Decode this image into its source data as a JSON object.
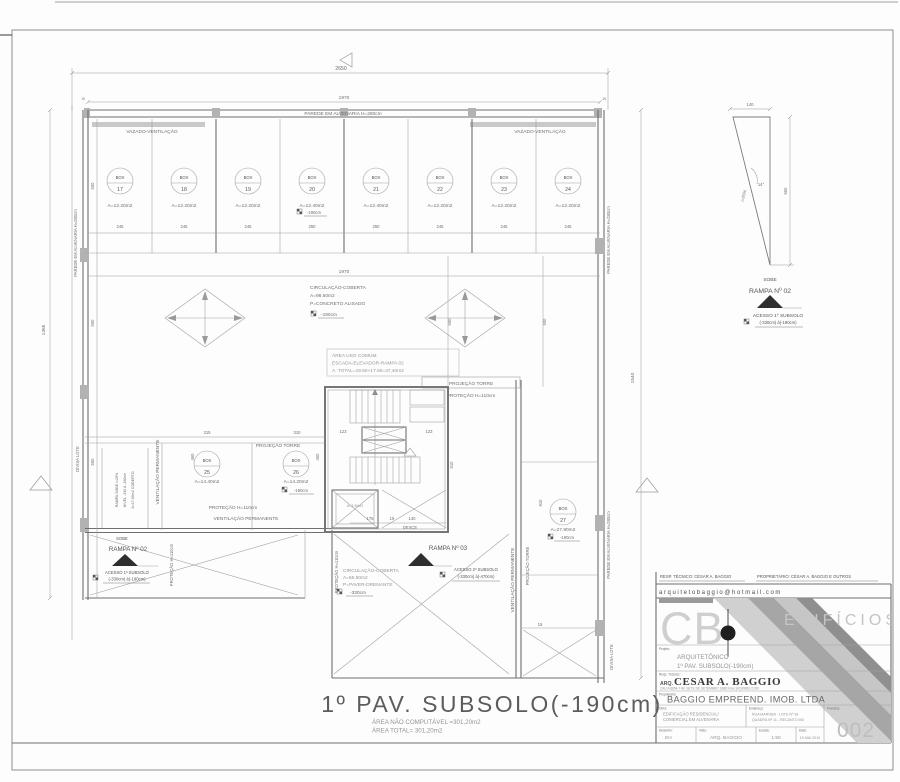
{
  "plan": {
    "title": "1º PAV. SUBSOLO(-190cm)",
    "area_nc": "ÁREA NÃO COMPUTÁVEL =301,20m2",
    "area_total": "ÁREA TOTAL= 301,20m2",
    "dims": {
      "overall_width": "2650",
      "top_width": "1970",
      "top_width_b": "1970",
      "left_height": "1365",
      "right_height": "1540",
      "left_500_a": "500",
      "left_500_b": "500",
      "left_550": "550",
      "mid_500_a": "500",
      "mid_500_b": "500",
      "d315": "315",
      "d310": "310",
      "d460_a": "460",
      "d460_b": "460",
      "d510": "510",
      "d910": "910",
      "d123_a": "123",
      "d123_b": "123",
      "d175": "175",
      "d15_a": "15",
      "d140": "140",
      "d15_left": "15",
      "d15_right": "15",
      "d15_c": "15"
    },
    "boxes_top": [
      {
        "label": "BOX",
        "num": "17",
        "area": "A=12.20m2",
        "w": "245"
      },
      {
        "label": "BOX",
        "num": "18",
        "area": "A=12.20m2",
        "w": "245"
      },
      {
        "label": "BOX",
        "num": "19",
        "area": "A=12.20m2",
        "w": "245"
      },
      {
        "label": "BOX",
        "num": "20",
        "area": "A=12.40m2",
        "w": "250",
        "level": "-190cm"
      },
      {
        "label": "BOX",
        "num": "21",
        "area": "A=12.40m2",
        "w": "250"
      },
      {
        "label": "BOX",
        "num": "22",
        "area": "A=12.20m2",
        "w": "245"
      },
      {
        "label": "BOX",
        "num": "23",
        "area": "A=12.20m2",
        "w": "245"
      },
      {
        "label": "BOX",
        "num": "24",
        "area": "A=12.20m2",
        "w": "245"
      }
    ],
    "box25": {
      "label": "BOX",
      "num": "25",
      "area": "A=14.40m2"
    },
    "box26": {
      "label": "BOX",
      "num": "26",
      "area": "A=14.20m2",
      "level": "-190cm"
    },
    "box27": {
      "label": "BOX",
      "num": "27",
      "area": "A=27.90m2",
      "level": "-190cm"
    },
    "walls": {
      "top": "PAREDE EM ALVENARIA H=280cm",
      "left": "PAREDE EM ALVENARIA H=280cm",
      "right_upper": "PAREDE EM ALVENARIA H=280cm",
      "right_lower": "PAREDE EM ALVENARIA H=280cm"
    },
    "vazado_left": "VAZADO-VENTILAÇÃO",
    "vazado_right": "VAZADO-VENTILAÇÃO",
    "circulacao_top": {
      "l1": "CIRCULAÇÃO-COBERTA",
      "l2": "A=98.50m2",
      "l3": "P=CONCRETO ALISADO",
      "level": "-190cm"
    },
    "area_comum": {
      "l1": "ÁREA USO COMUM",
      "l2": "ESCADA-ELEVADOR-RAMPA 02",
      "l3": "A. TOTAL=19.60+17.60=37,40m2"
    },
    "proj_torre_label": "PROJEÇÃO TORRE",
    "protecao_label": "PROTEÇÃO H=110cm",
    "proj_torre_left": "PROJEÇÃO TORRE",
    "protecao_left": "PROTEÇÃO H=110cm",
    "vent_perm_left_h": "VENTILAÇÃO PERMANENTE",
    "vent_perm_left_v": "VENTILAÇÃO PERMANENTE",
    "vent_perm_right_v": "VENTILAÇÃO PERMANENTE",
    "protecao_v_a": "PROTEÇÃO H=110cm",
    "protecao_v_b": "PROTEÇÃO H=110cm",
    "proj_torre_v": "PROJEÇÃO TORRE",
    "divisa_lote_left": "DIVISA LOTE",
    "divisa_lote_right": "DIVISA LOTE",
    "rampa_left": {
      "l1": "RAMPA SOBE i=25%",
      "l2": "NIVEL -330 A -190cm",
      "l3": "A=17.60m2 COBERTO"
    },
    "rampa02": {
      "sobe": "SOBE",
      "title": "RAMPA Nº 02",
      "acesso1": "ACESSO 1º SUBSOLO",
      "acesso2": "(-330cm) à(-190cm)"
    },
    "rampa03": {
      "desce": "DESCE",
      "title": "RAMPA Nº 03",
      "acesso1": "ACESSO 2º SUBSOLO",
      "acesso2": "(-330cm) à(-470cm)"
    },
    "circulacao_bottom": {
      "l1": "CIRCULAÇÃO-COBERTA",
      "l2": "A=65.90m2",
      "l3": "P=PAVER-DRENANTE",
      "level": "-330cm"
    },
    "pit_area": "A=3.30m2"
  },
  "ramp_detail": {
    "w": "140",
    "h": "560",
    "slope": "i=25%",
    "angle": "14°",
    "sobe": "SOBE",
    "title": "RAMPA Nº 02",
    "acesso1": "ACESSO 1º SUBSOLO",
    "acesso2": "(-330cm) à(-190cm)"
  },
  "titleblock": {
    "resp_row": "RESP. TÉCNICO: CÉSAR A. BAGGIO",
    "prop_row": "PROPRIETÁRIO: CÉSAR A. BAGGIO E OUTROS",
    "email": "arquitetobaggio@hotmail.com",
    "logo_cb": "CB",
    "logo_edificios": "EDIFÍCIOS",
    "projeto_label": "Projeto:",
    "projeto_l1": "ARQUITETÔNICO",
    "projeto_l2": "1º PAV. SUBSOLO(-190cm)",
    "resp_label": "Resp. Técnico:",
    "resp_name_prefix": "ARQ.",
    "resp_name": "CESAR A. BAGGIO",
    "resp_detail": "CAU A 8854-7  AV. SETE DE SETEMBRO 1888  Fone:(41)99862-2199",
    "prop_label": "Proprietário:",
    "prop_name": "BAGGIO EMPREEND. IMOB. LTDA",
    "obra_label": "Obra:",
    "obra_l1": "EDIFICAÇÃO RESIDENCIAL/",
    "obra_l2": "COMERCIAL EM ALVENARIA",
    "endereco_label": "Endereço:",
    "endereco_l1": "RUA MAROBA - LOTE Nº 28",
    "endereco_l2": "QUADRA Nº 11 - RECANTO MG",
    "prancha_label": "Prancha:",
    "prancha": "002",
    "desenho_label": "Desenho:",
    "desenho": "EH",
    "visto_label": "Visto:",
    "visto": "ARQ. BAGGIO",
    "escala_label": "Escala:",
    "escala": "1:50",
    "data_label": "Data:",
    "data": "15 MAI 2019"
  }
}
